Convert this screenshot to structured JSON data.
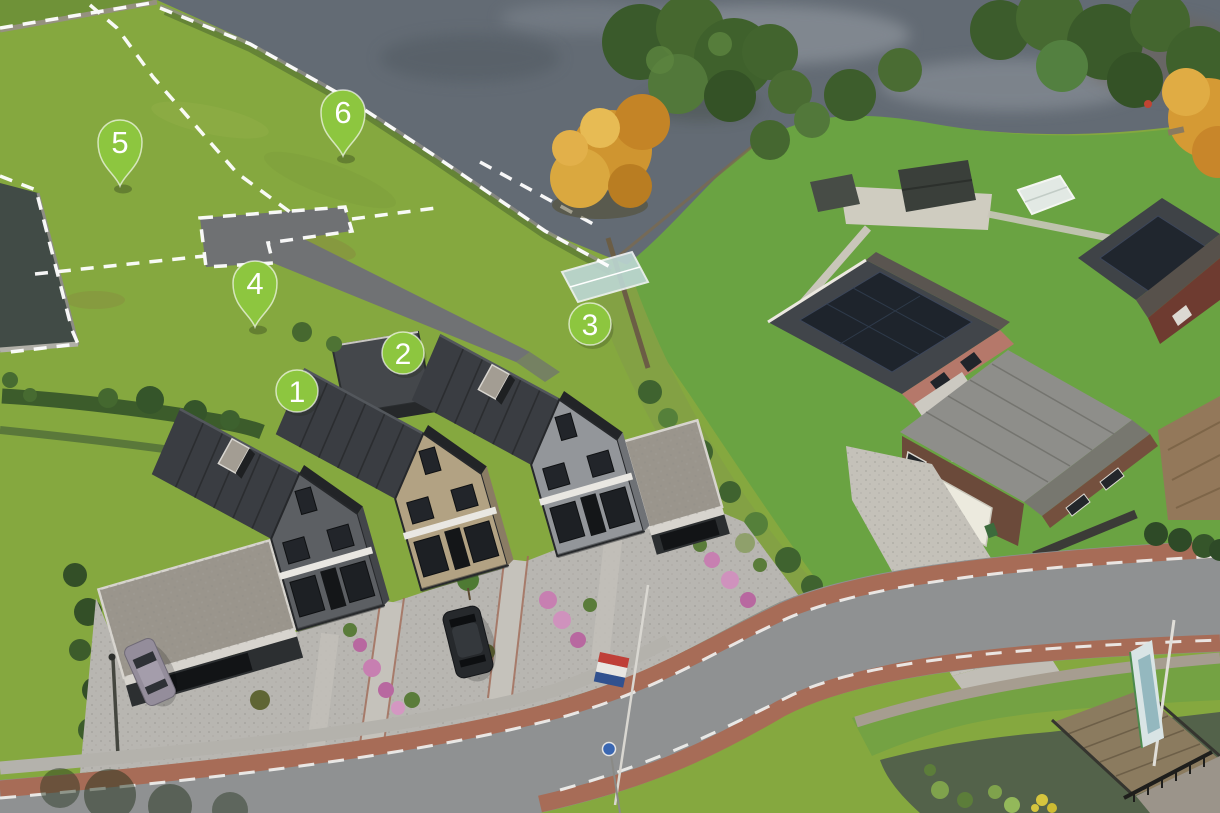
{
  "view": {
    "width": 1220,
    "height": 813,
    "kind": "aerial-site-plan"
  },
  "palette": {
    "marker_green": "#8dc63f",
    "marker_text": "#ffffff",
    "boundary_dash": "#ffffff",
    "water_top": "#636b74",
    "river_left": "#414b46",
    "field_grass": "#85a83f",
    "garden_grass": "#6aa342",
    "roof_dark": "#3a3d42",
    "brick_dark_gray": "#5c5f63",
    "brick_tan": "#b2a283",
    "brick_light_gray": "#93969a",
    "road_asphalt": "#8f9192",
    "cycle_lane_red": "#a96a54",
    "lane_dash": "#f0f0ee",
    "gravel_light": "#b8b6b1"
  },
  "markers": [
    {
      "id": "house-1",
      "label": "1",
      "type": "circle",
      "x": 297,
      "y": 391
    },
    {
      "id": "house-2",
      "label": "2",
      "type": "circle",
      "x": 403,
      "y": 353
    },
    {
      "id": "house-3",
      "label": "3",
      "type": "circle",
      "x": 590,
      "y": 324
    },
    {
      "id": "plot-4",
      "label": "4",
      "type": "pin",
      "x": 255,
      "y": 283
    },
    {
      "id": "plot-5",
      "label": "5",
      "type": "pin",
      "x": 120,
      "y": 142
    },
    {
      "id": "plot-6",
      "label": "6",
      "type": "pin",
      "x": 343,
      "y": 112
    }
  ]
}
